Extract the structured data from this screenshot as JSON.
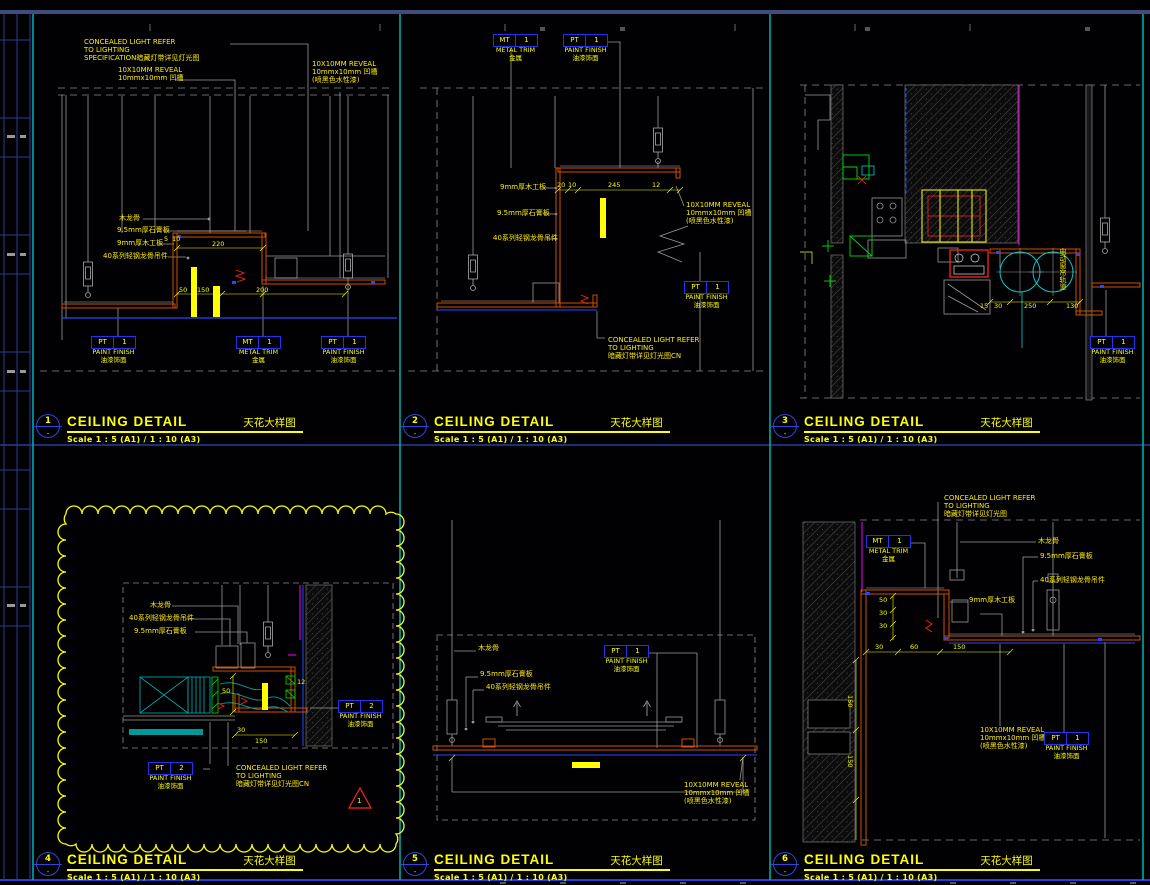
{
  "sheet": {
    "bubble_dash": "-",
    "colors": {
      "background": "#010103",
      "divider_cyan": "#00b2b2",
      "frame_blue": "#3e4c80",
      "line_blue": "#2846ff",
      "annotation_yellow": "#ffff00",
      "profile_orange": "#d05000",
      "tag_border_blue": "#2233ee",
      "linework_gray": "#9a9a9a",
      "hatch_gray": "#4a4a4a",
      "magenta": "#ff00ff",
      "green": "#00dd00",
      "teal": "#009999",
      "red": "#ff2222"
    }
  },
  "panels": [
    {
      "num": "1",
      "title": "CEILING DETAIL",
      "title_cn": "天花大样图",
      "scale": "Scale 1 : 5 (A1) / 1 : 10 (A3)",
      "ann": {
        "concealed": [
          "CONCEALED LIGHT REFER",
          "TO LIGHTING",
          "SPECIFICATION暗藏灯带详见灯光图"
        ],
        "reveal_left": [
          "10X10MM REVEAL",
          "10mmx10mm 凹槽"
        ],
        "reveal_right": [
          "10X10MM REVEAL",
          "10mmx10mm 凹槽",
          "(喷黑色水性漆)"
        ],
        "materials": [
          "木龙骨",
          "9.5mm厚石膏板",
          "9mm厚木工板",
          "40系列轻钢龙骨吊件"
        ]
      },
      "dims": [
        "5",
        "10",
        "220",
        "150",
        "50",
        "200"
      ],
      "tags": [
        {
          "code": "PT",
          "no": "1",
          "name": "PAINT FINISH",
          "cn": "油漆饰面"
        },
        {
          "code": "MT",
          "no": "1",
          "name": "METAL TRIM",
          "cn": "金属"
        },
        {
          "code": "PT",
          "no": "1",
          "name": "PAINT FINISH",
          "cn": "油漆饰面"
        }
      ]
    },
    {
      "num": "2",
      "title": "CEILING DETAIL",
      "title_cn": "天花大样图",
      "scale": "Scale 1 : 5 (A1) / 1 : 10 (A3)",
      "ann": {
        "concealed": [
          "CONCEALED LIGHT REFER",
          "TO LIGHTING",
          "暗藏灯带详见灯光图CN"
        ],
        "reveal": [
          "10X10MM REVEAL",
          "10mmx10mm 凹槽",
          "(喷黑色水性漆)"
        ],
        "materials": [
          "9mm厚木工板",
          "9.5mm厚石膏板",
          "40系列轻钢龙骨吊件"
        ]
      },
      "dims": [
        "20",
        "10",
        "245",
        "12"
      ],
      "tags": [
        {
          "code": "MT",
          "no": "1",
          "name": "METAL TRIM",
          "cn": "金属"
        },
        {
          "code": "PT",
          "no": "1",
          "name": "PAINT FINISH",
          "cn": "油漆饰面"
        },
        {
          "code": "PT",
          "no": "1",
          "name": "PAINT FINISH",
          "cn": "油漆饰面"
        }
      ]
    },
    {
      "num": "3",
      "title": "CEILING DETAIL",
      "title_cn": "天花大样图",
      "scale": "Scale 1 : 5 (A1) / 1 : 10 (A3)",
      "ann": {
        "curtain": "电动窗帘轨道"
      },
      "dims": [
        "15",
        "30",
        "250",
        "130"
      ],
      "tags": [
        {
          "code": "PT",
          "no": "1",
          "name": "PAINT FINISH",
          "cn": "油漆饰面"
        }
      ]
    },
    {
      "num": "4",
      "title": "CEILING DETAIL",
      "title_cn": "天花大样图",
      "scale": "Scale 1 : 5 (A1) / 1 : 10 (A3)",
      "ann": {
        "concealed": [
          "CONCEALED LIGHT REFER",
          "TO LIGHTING",
          "暗藏灯带详见灯光图CN"
        ],
        "materials": [
          "木龙骨",
          "40系列轻钢龙骨吊件",
          "9.5mm厚石膏板"
        ]
      },
      "dims": [
        "12",
        "50",
        "30",
        "150"
      ],
      "revision": "1",
      "tags": [
        {
          "code": "PT",
          "no": "2",
          "name": "PAINT FINISH",
          "cn": "油漆饰面"
        },
        {
          "code": "PT",
          "no": "2",
          "name": "PAINT FINISH",
          "cn": "油漆饰面"
        }
      ]
    },
    {
      "num": "5",
      "title": "CEILING DETAIL",
      "title_cn": "天花大样图",
      "scale": "Scale 1 : 5 (A1) / 1 : 10 (A3)",
      "ann": {
        "reveal": [
          "10X10MM REVEAL",
          "10mmx10mm 凹槽",
          "(喷黑色水性漆)"
        ],
        "materials": [
          "木龙骨",
          "9.5mm厚石膏板",
          "40系列轻钢龙骨吊件"
        ]
      },
      "dims": [],
      "tags": [
        {
          "code": "PT",
          "no": "1",
          "name": "PAINT FINISH",
          "cn": "油漆饰面"
        }
      ]
    },
    {
      "num": "6",
      "title": "CEILING DETAIL",
      "title_cn": "天花大样图",
      "scale": "Scale 1 : 5 (A1) / 1 : 10 (A3)",
      "ann": {
        "concealed": [
          "CONCEALED LIGHT REFER",
          "TO LIGHTING",
          "暗藏灯带详见灯光图"
        ],
        "reveal": [
          "10X10MM REVEAL",
          "10mmx10mm 凹槽",
          "(喷黑色水性漆)"
        ],
        "materials": [
          "木龙骨",
          "9.5mm厚石膏板",
          "40系列轻钢龙骨吊件"
        ],
        "board": "9mm厚木工板"
      },
      "dims": [
        "50",
        "30",
        "30",
        "30",
        "60",
        "150",
        "150",
        "150"
      ],
      "tags": [
        {
          "code": "MT",
          "no": "1",
          "name": "METAL TRIM",
          "cn": "金属"
        },
        {
          "code": "PT",
          "no": "1",
          "name": "PAINT FINISH",
          "cn": "油漆饰面"
        }
      ]
    }
  ]
}
